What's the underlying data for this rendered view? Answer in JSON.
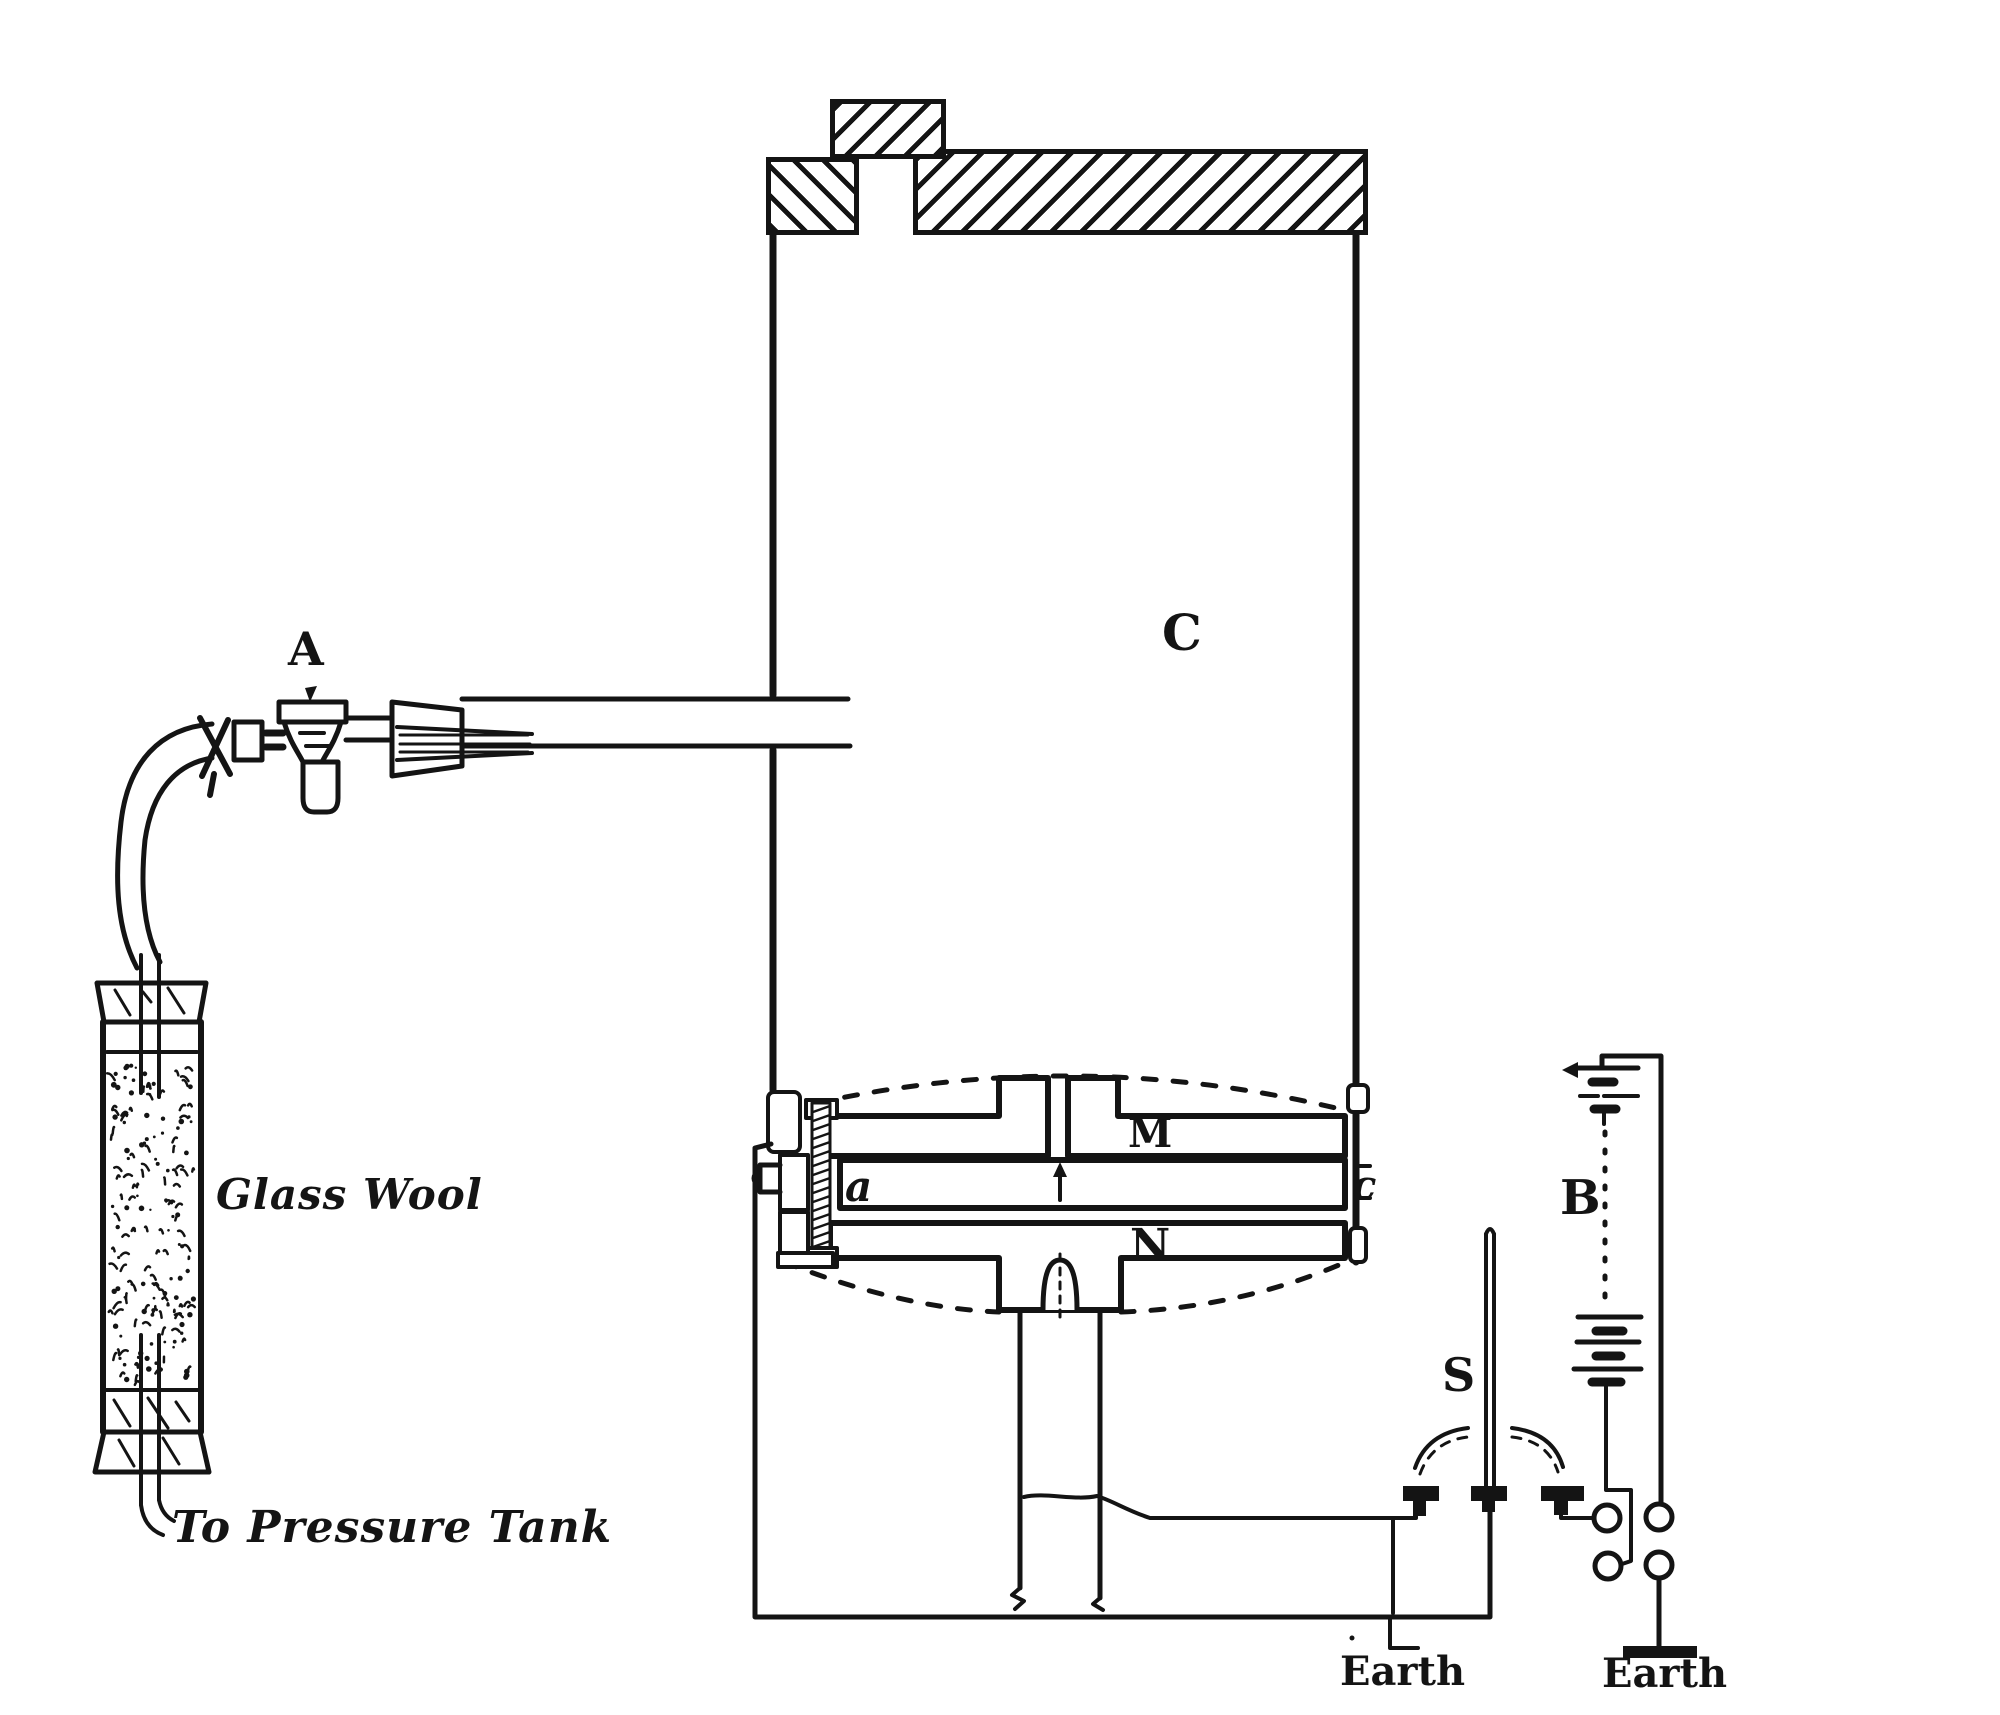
{
  "diagram": {
    "ink_color": "#141414",
    "paper_color": "#ffffff",
    "labels": {
      "stopcock": "A",
      "chamber": "C",
      "upper_plate": "M",
      "lower_plate": "N",
      "mid_plate_left": "a",
      "mid_plate_right": "c",
      "charging_rod": "S",
      "battery": "B",
      "filter": "Glass Wool",
      "pressure_tank": "To Pressure Tank",
      "earth_left": "Earth",
      "earth_right": "Earth"
    }
  }
}
